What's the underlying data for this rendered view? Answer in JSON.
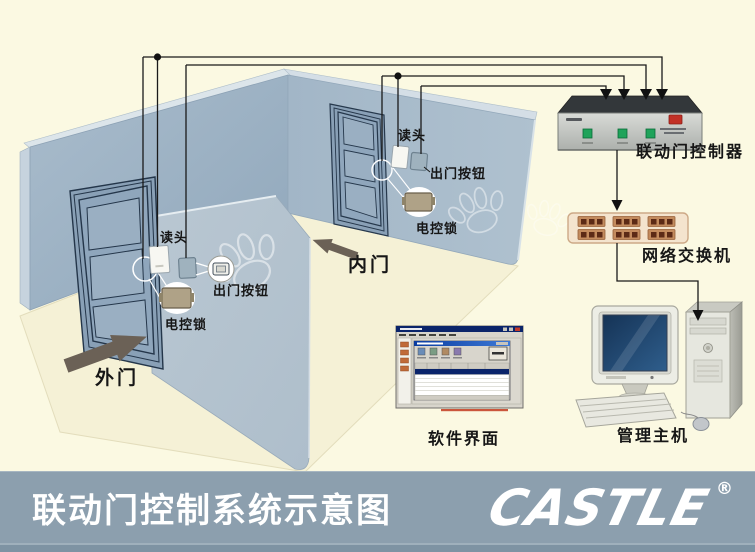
{
  "scene": {
    "outer_door": {
      "door_label": "外门",
      "reader_label": "读头",
      "exit_button_label": "出门按钮",
      "lock_label": "电控锁"
    },
    "inner_door": {
      "door_label": "内门",
      "reader_label": "读头",
      "exit_button_label": "出门按钮",
      "lock_label": "电控锁"
    },
    "devices": {
      "controller_label": "联动门控制器",
      "switch_label": "网络交换机",
      "software_label": "软件界面",
      "host_label": "管理主机"
    }
  },
  "banner": {
    "title": "联动门控制系统示意图",
    "logo_text": "CASTLE",
    "registered_mark": "®"
  },
  "icons": {
    "outer_door_arrow": "block-arrow-up-right",
    "inner_door_arrow": "block-arrow-up-left",
    "paw_watermark": "paw-print-watermark",
    "wire_junction": "junction-dot",
    "wire_arrow": "arrowhead-down"
  },
  "colors": {
    "background": "#FBF9E2",
    "wall_left": "#9DB2C5",
    "wall_right": "#A9BCCB",
    "wall_partition": "#B4C2CF",
    "floor": "#F5F1D6",
    "banner_bg": "#8C9FAE",
    "banner_strip": "#7E93A3",
    "wire": "#1A1A1A",
    "arrow_fill": "#6B6156",
    "controller_led_green": "#1FA35A",
    "controller_switch_red": "#C23026",
    "switch_body": "#F4E4CE",
    "screen_blue": "#1C3E66",
    "software_titlebar_blue": "#0A246A",
    "watermark": "#FFFFFF"
  }
}
